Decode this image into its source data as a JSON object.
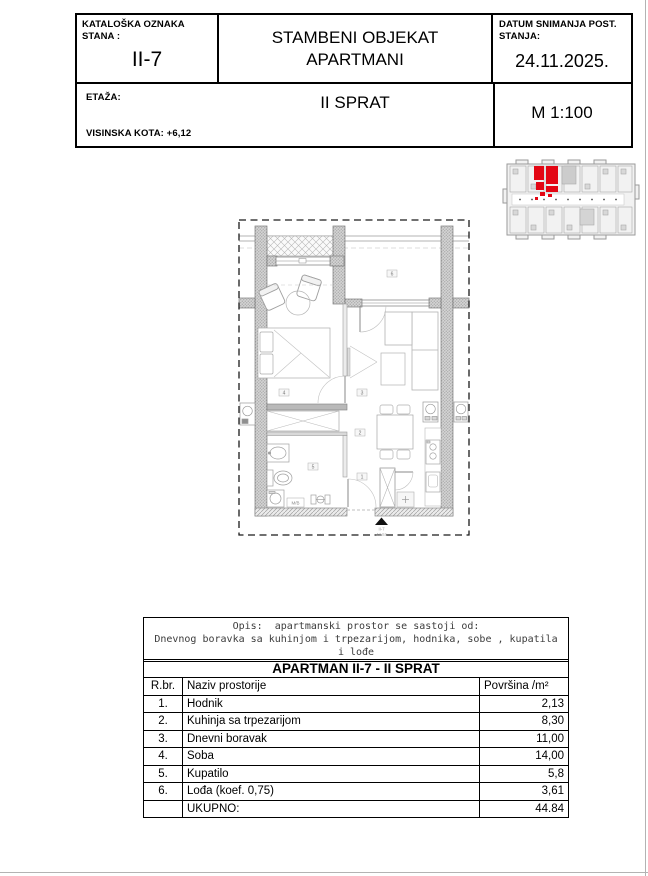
{
  "header": {
    "catalog_label_line1": "KATALOŠKA OZNAKA",
    "catalog_label_line2": "STANA :",
    "catalog_value": "II-7",
    "object_title_line1": "STAMBENI OBJEKAT",
    "object_title_line2": "APARTMANI",
    "date_label_line1": "DATUM SNIMANJA POST.",
    "date_label_line2": "STANJA:",
    "date_value": "24.11.2025.",
    "etaza_label": "ETAŽA:",
    "etaza_value": "II SPRAT",
    "kota_label": "VISINSKA KOTA:  +6,12",
    "scale_value": "M  1:100"
  },
  "plan": {
    "room_labels": [
      "1",
      "2",
      "3",
      "4",
      "5",
      "6"
    ],
    "entrance_unit": "II-7",
    "entrance_area": "44.84",
    "washer_label": "M/B"
  },
  "colors": {
    "highlight_red": "#e30613"
  },
  "description": {
    "line1": "Opis:  apartmanski prostor se sastoji od:",
    "line2": "Dnevnog boravka sa kuhinjom i trpezarijom, hodnika, sobe , kupatila",
    "line3": "i lođe"
  },
  "apartment_table": {
    "title": "APARTMAN II-7 - II SPRAT",
    "col_rbr": "R.br.",
    "col_name": "Naziv prostorije",
    "col_area": "Površina /m²",
    "rows": [
      {
        "num": "1.",
        "name": "Hodnik",
        "area": "2,13"
      },
      {
        "num": "2.",
        "name": "Kuhinja sa trpezarijom",
        "area": "8,30"
      },
      {
        "num": "3.",
        "name": "Dnevni boravak",
        "area": "11,00"
      },
      {
        "num": "4.",
        "name": "Soba",
        "area": "14,00"
      },
      {
        "num": "5.",
        "name": "Kupatilo",
        "area": "5,8"
      },
      {
        "num": "6.",
        "name": "Lođa (koef. 0,75)",
        "area": "3,61"
      }
    ],
    "total_label": "UKUPNO:",
    "total_value": "44.84"
  }
}
